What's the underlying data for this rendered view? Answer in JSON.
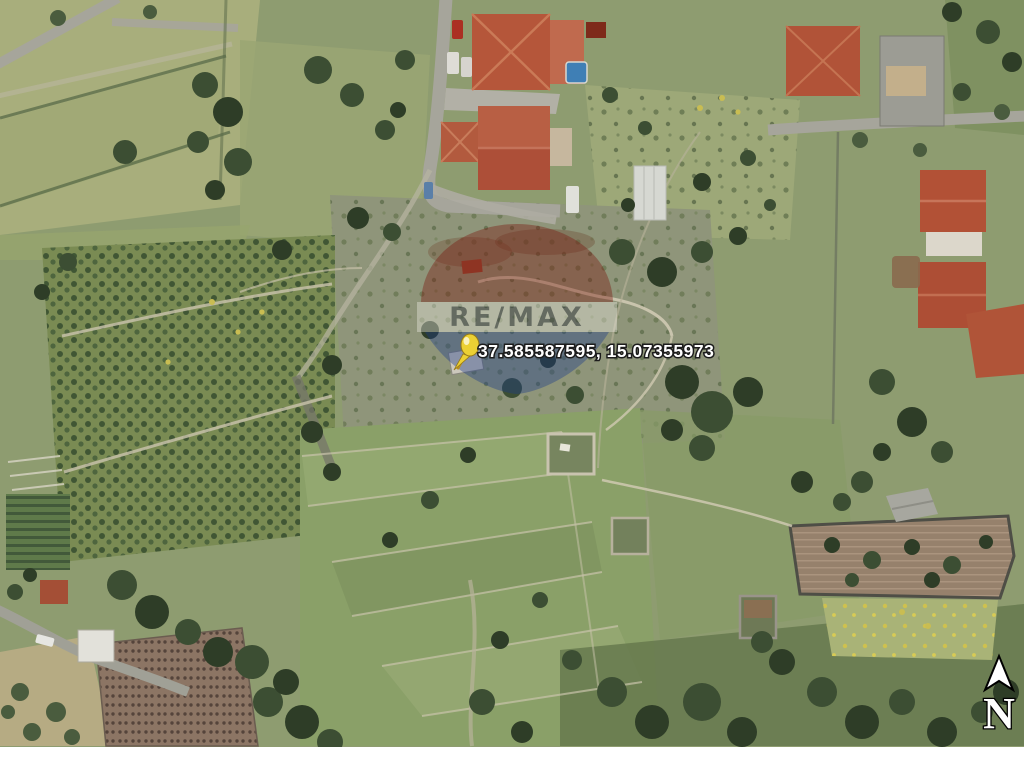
{
  "map": {
    "view": "satellite-aerial-photo",
    "marker": {
      "icon": "yellow-pushpin",
      "pin_color": "#ecd034",
      "coordinates": "37.585587595, 15.07355973",
      "label_color": "#ffffff"
    },
    "watermark": {
      "brand": "RE/MAX",
      "style": "balloon-logo-semi-transparent",
      "balloon_red": "#7a130b",
      "balloon_white": "#f2efe6",
      "balloon_blue": "#1b3a8a"
    },
    "compass": {
      "icon": "north-arrow",
      "label": "N"
    },
    "frame": {
      "bottom_margin_color": "#ffffff"
    }
  }
}
